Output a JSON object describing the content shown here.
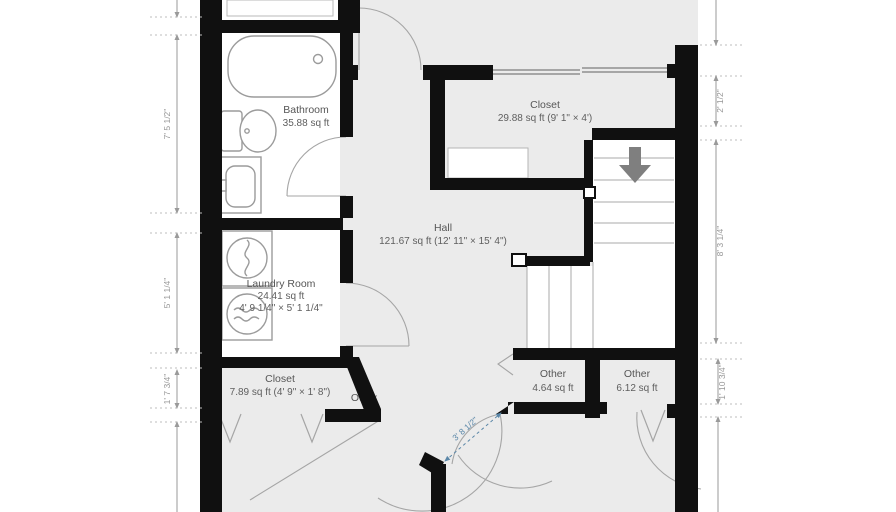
{
  "plan": {
    "title": "floor-plan",
    "rooms": {
      "bathroom": {
        "name": "Bathroom",
        "area": "35.88 sq ft"
      },
      "closet_top": {
        "name": "Closet",
        "area": "29.88 sq ft (9' 1\" × 4')"
      },
      "hall": {
        "name": "Hall",
        "area": "121.67 sq ft (12' 11\" × 15' 4\")"
      },
      "laundry": {
        "name": "Laundry Room",
        "area": "24.41 sq ft",
        "dims": "4' 9 1/4\" × 5' 1 1/4\""
      },
      "closet_bottom": {
        "name": "Closet",
        "area": "7.89 sq ft (4' 9\" × 1' 8\")"
      },
      "other_small": {
        "name": "Other"
      },
      "other_a": {
        "name": "Other",
        "area": "4.64 sq ft"
      },
      "other_b": {
        "name": "Other",
        "area": "6.12 sq ft"
      }
    },
    "dimensions": {
      "left": [
        "7' 5 1/2\"",
        "5' 1 1/4\"",
        "1' 7 3/4\""
      ],
      "right": [
        "2' 1/2\"",
        "8' 3 1/4\"",
        "1' 10 3/4\""
      ],
      "door": "3' 8 1/2\""
    },
    "icons": {
      "stairs_direction": "down-arrow"
    },
    "colors": {
      "wall": "#101010",
      "floor": "#ebebeb",
      "fixture_stroke": "#9b9b9b",
      "dimension": "#9a9a9a",
      "door_dimension": "#5b87a8",
      "stairs_arrow": "#7f7f7f",
      "label": "#565656"
    }
  }
}
